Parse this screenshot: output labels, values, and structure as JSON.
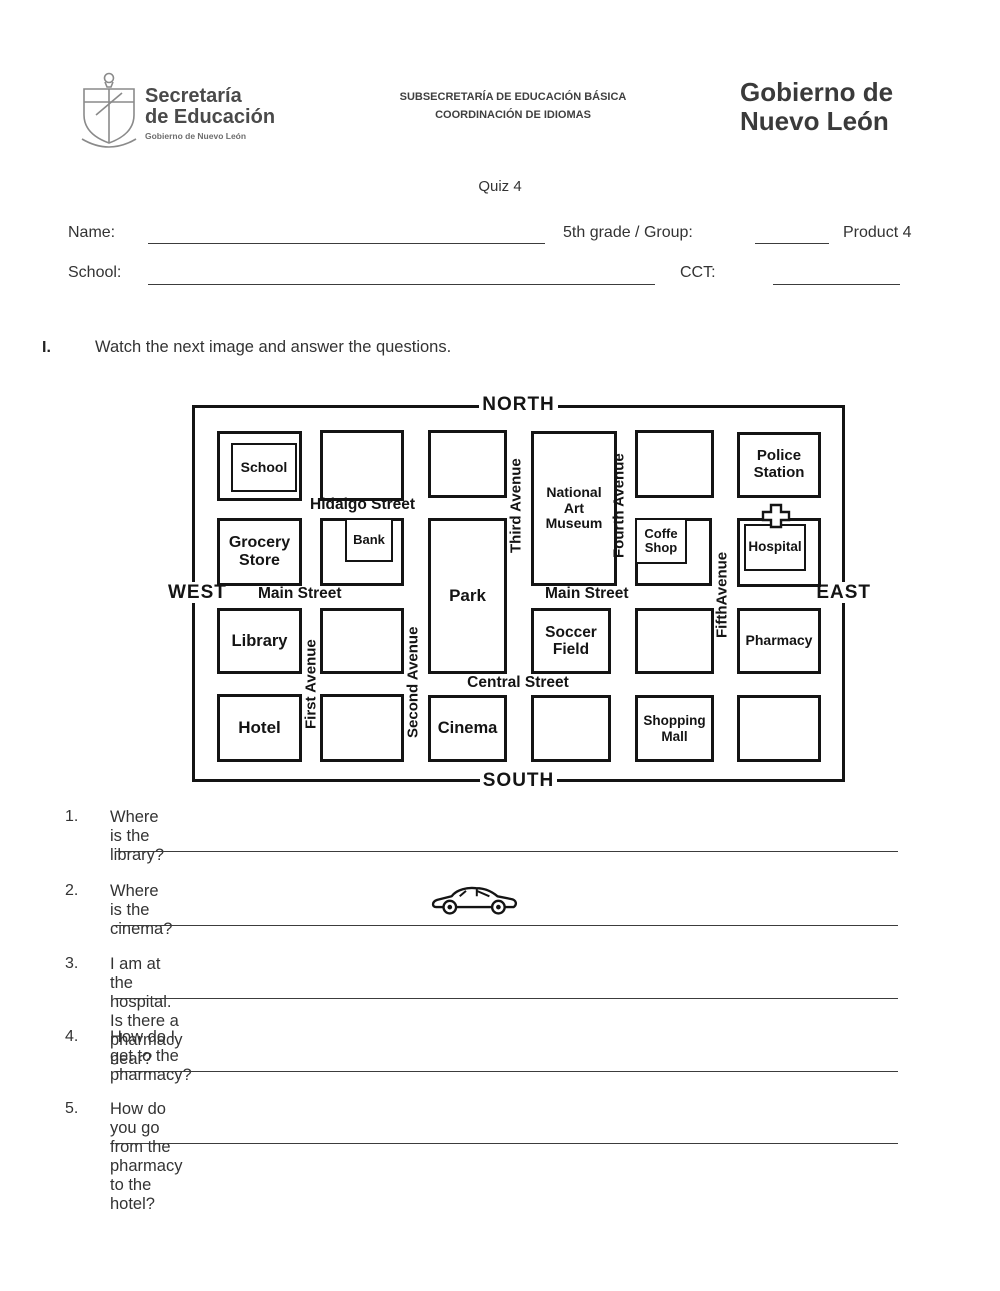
{
  "colors": {
    "ink": "#141414",
    "text": "#333333",
    "header_gray": "#4a4a4a",
    "gov_gray": "#3a3a3a"
  },
  "header": {
    "logo": "coat-of-arms",
    "ministry_line1": "Secretaría",
    "ministry_line2": "de Educación",
    "ministry_sub": "Gobierno de Nuevo León",
    "center_line1": "SUBSECRETARÍA DE EDUCACIÓN BÁSICA",
    "center_line2": "COORDINACIÓN DE IDIOMAS",
    "gov_line1": "Gobierno de",
    "gov_line2": "Nuevo León"
  },
  "quiz": {
    "title": "Quiz 4",
    "name_label": "Name:",
    "grade_label": "5th grade / Group:",
    "product_label": "Product 4",
    "school_label": "School:",
    "cct_label": "CCT:"
  },
  "instruction": {
    "number": "I.",
    "text": "Watch the next image and answer the questions."
  },
  "map": {
    "compass": {
      "north": "NORTH",
      "south": "SOUTH",
      "west": "WEST",
      "east": "EAST"
    },
    "streets": {
      "hidalgo": "Hidalgo Street",
      "main_left": "Main Street",
      "main_right": "Main Street",
      "central": "Central Street"
    },
    "avenues": {
      "first": "First Avenue",
      "second": "Second Avenue",
      "third": "Third Avenue",
      "fourth": "Fourth Avenue",
      "fifth": "FifthAvenue"
    },
    "places": {
      "school": "School",
      "police": "Police Station",
      "grocery": "Grocery Store",
      "bank": "Bank",
      "museum": "National Art Museum",
      "coffe": "Coffe Shop",
      "hospital": "Hospital",
      "library": "Library",
      "park": "Park",
      "soccer": "Soccer Field",
      "pharmacy": "Pharmacy",
      "hotel": "Hotel",
      "cinema": "Cinema",
      "shopping": "Shopping Mall"
    },
    "icons": {
      "car": "car-icon",
      "cross": "hospital-cross-icon"
    }
  },
  "questions": [
    {
      "number": "1.",
      "text": "Where is the library?"
    },
    {
      "number": "2.",
      "text": "Where is the cinema?"
    },
    {
      "number": "3.",
      "text": "I am at the hospital. Is there a pharmacy near?"
    },
    {
      "number": "4.",
      "text": "How do I get to the pharmacy?"
    },
    {
      "number": "5.",
      "text": "How do you go from the pharmacy to the hotel?"
    }
  ]
}
